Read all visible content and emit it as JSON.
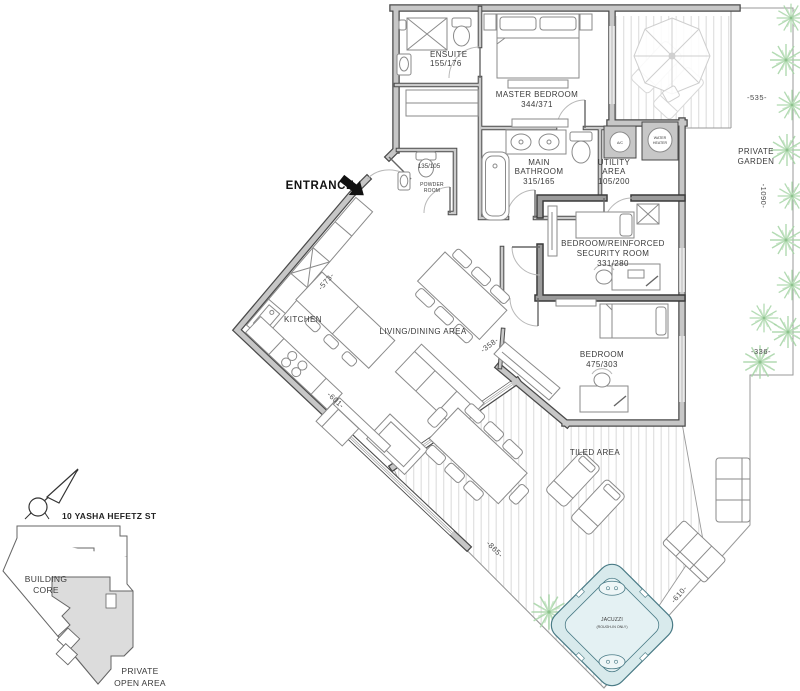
{
  "floor_plan": {
    "entrance": {
      "label": "ENTRANCE"
    },
    "rooms": {
      "ensuite": {
        "name": "ENSUITE",
        "dims": "155/176"
      },
      "master_bedroom": {
        "name": "MASTER BEDROOM",
        "dims": "344/371"
      },
      "main_bathroom": {
        "line1": "MAIN",
        "line2": "BATHROOM",
        "dims": "315/165"
      },
      "utility_area": {
        "line1": "UTILITY",
        "line2": "AREA",
        "dims": "105/200"
      },
      "security_room": {
        "line1": "BEDROOM/REINFORCED",
        "line2": "SECURITY ROOM",
        "dims": "331/280"
      },
      "bedroom": {
        "name": "BEDROOM",
        "dims": "475/303"
      },
      "powder_room": {
        "line1": "POWDER",
        "line2": "ROOM",
        "dims": "135/105"
      },
      "kitchen": {
        "name": "KITCHEN"
      },
      "living_dining": {
        "name": "LIVING/DINING AREA"
      },
      "tiled_area": {
        "name": "TILED AREA"
      },
      "private_garden": {
        "line1": "PRIVATE",
        "line2": "GARDEN"
      },
      "jacuzzi": {
        "line1": "JACUZZI",
        "line2": "(ROUGH-IN ONLY)"
      }
    },
    "equipment": {
      "ac": "A/C",
      "water_heater_line1": "WATER",
      "water_heater_line2": "HEATER"
    },
    "dimensions": {
      "garden_top": "-535-",
      "garden_right": "-1090-",
      "garden_lower": "-336-",
      "kitchen_nw_wall": "-573-",
      "living_sw_wall": "-601-",
      "living_se_wall": "-358-",
      "tiled_sw_edge": "-865-",
      "tiled_se_edge": "-610-"
    },
    "keyplan": {
      "street": "10 YASHA HEFETZ ST",
      "building_core_line1": "BUILDING",
      "building_core_line2": "CORE",
      "open_area_line1": "PRIVATE",
      "open_area_line2": "OPEN AREA"
    },
    "colors": {
      "wall_gray": "#c7c7c7",
      "wall_edge": "#4a4a4a",
      "plant_green": "#a5d3a5",
      "jacuzzi_fill": "#d8eaec",
      "jacuzzi_stroke": "#4a7b86",
      "decking_stripe": "#e0e0e0",
      "keyplan_unit_fill": "#dcdcdc"
    }
  }
}
